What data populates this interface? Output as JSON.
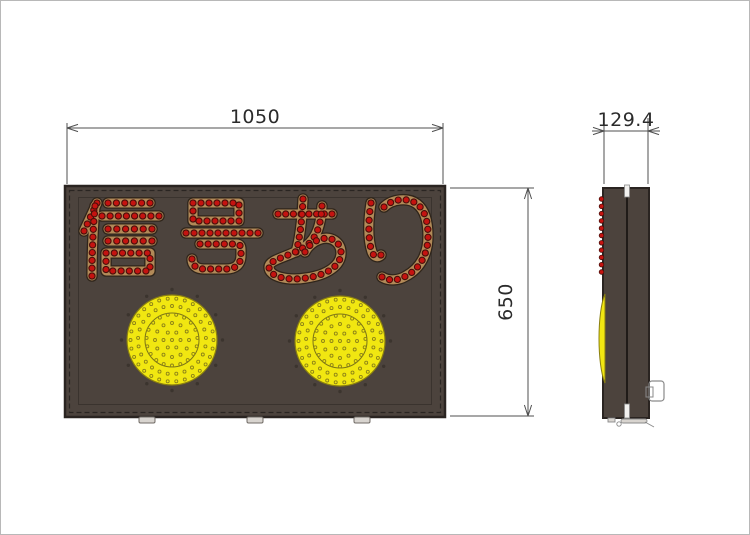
{
  "page": {
    "background": "#ffffff",
    "frame_color": "#b8b8b8"
  },
  "colors": {
    "panel": "#4c433d",
    "panel_border": "#2a2421",
    "dashed_line": "#2a2522",
    "inner_line": "#3a332e",
    "tan": "#b28a58",
    "tan_outline": "#2f251b",
    "led_red": "#c51310",
    "led_red_dark": "#4a0f0a",
    "lamp_yellow": "#f1e711",
    "lamp_edge": "#8a7f11",
    "lamp_inner_ring": "#7c7516",
    "lamp_dot": "#8c8218",
    "screw": "#3b342e",
    "foot_fill": "#d8d4cf",
    "foot_edge": "#6f6a64",
    "bracket": "#8a8a8a",
    "dim_line": "#4f4f4f",
    "dim_text": "#2b2b2b"
  },
  "front_view": {
    "panel": {
      "x": 65,
      "y": 186,
      "w": 380,
      "h": 231
    },
    "dashed_rect": {
      "x": 69.5,
      "y": 190.5,
      "w": 371,
      "h": 222
    },
    "inner_rect": {
      "x": 78.5,
      "y": 197.5,
      "w": 353,
      "h": 207
    },
    "sign_text": "信号あり",
    "stroke_width": 9,
    "outline_extra": 2.6,
    "led_spacing": 8.2,
    "led_radius": 3.1,
    "characters": [
      {
        "char": "信",
        "strokes": [
          "M 97,203 L 84,231",
          "M 95,206 C 93,230 92,252 92,276",
          "M 108,203 L 150,203",
          "M 102,216 L 159,216",
          "M 108,229 L 152,229",
          "M 108,241 L 152,241",
          "M 106,253 L 150,253 L 150,271 L 106,271 Z"
        ]
      },
      {
        "char": "号",
        "strokes": [
          "M 193,203 L 239,203 L 239,221 L 193,221 Z",
          "M 186,233 L 258,233",
          "M 200,244 L 236,244 C 240,244 241,246 241,250 L 241,255 C 241,265 235,269 226,269 L 204,269 C 196,269 192,265 192,259"
        ]
      },
      {
        "char": "あ",
        "strokes": [
          "M 278,214 L 332,214",
          "M 303,199 C 302,220 300,238 296,252",
          "M 322,206 C 321,224 317,238 306,246 C 290,257 269,259 269,267 C 269,277 288,281 306,278 C 328,275 341,265 341,253 C 341,242 331,236 321,239 C 314,241 308,246 305,252"
        ]
      },
      {
        "char": "り",
        "strokes": [
          "M 371,203 C 368,222 368,240 372,252 C 374,257 378,258 381,255",
          "M 384,207 C 392,199 408,197 417,204 C 426,211 428,224 428,236 C 428,253 421,268 406,276 C 398,281 388,281 382,277"
        ]
      }
    ],
    "lamps": [
      {
        "cx": 172,
        "cy": 340,
        "r": 45
      },
      {
        "cx": 340,
        "cy": 341,
        "r": 45
      }
    ],
    "lamp_inner_r": 27,
    "lamp_dot_rings": [
      0,
      8.5,
      17,
      25.5,
      34,
      41.5
    ],
    "lamp_dot_spacing": 8.6,
    "screw_r": 50.5,
    "screw_count": 12,
    "feet_x": [
      147,
      255,
      362
    ]
  },
  "side_view": {
    "body": {
      "x": 603,
      "y": 188,
      "w": 46,
      "h": 230
    },
    "split_x": 627,
    "top_tab": {
      "x": 624.5,
      "y": 185,
      "w": 5,
      "h": 12
    },
    "bottom_tab": {
      "x": 624.5,
      "y": 404,
      "w": 5,
      "h": 14
    },
    "leds": {
      "x": 601.5,
      "y0": 199,
      "step": 7.3,
      "count": 11,
      "r": 2.3
    },
    "bulge": {
      "x": 605,
      "y0": 294,
      "y1": 383,
      "depth": 8
    },
    "bracket": {
      "x": 649,
      "y": 381,
      "w": 15,
      "h": 20
    },
    "tab": {
      "x": 646,
      "y": 387,
      "w": 7,
      "h": 10
    }
  },
  "dimensions": {
    "width": {
      "label": "1050",
      "line_y": 128,
      "x0": 67,
      "x1": 443,
      "ext_y0": 123,
      "ext_y1": 184,
      "text_x": 255,
      "text_y": 123
    },
    "height": {
      "label": "650",
      "line_x": 528,
      "y0": 188,
      "y1": 416,
      "ext_x0": 450,
      "ext_x1": 534,
      "text_x": 512,
      "text_y": 302
    },
    "depth": {
      "label": "129.4",
      "line_y": 131,
      "x0": 604,
      "x1": 648,
      "tail": 12,
      "ext_y0": 118,
      "ext_y1": 184,
      "text_x": 626,
      "text_y": 126
    }
  }
}
